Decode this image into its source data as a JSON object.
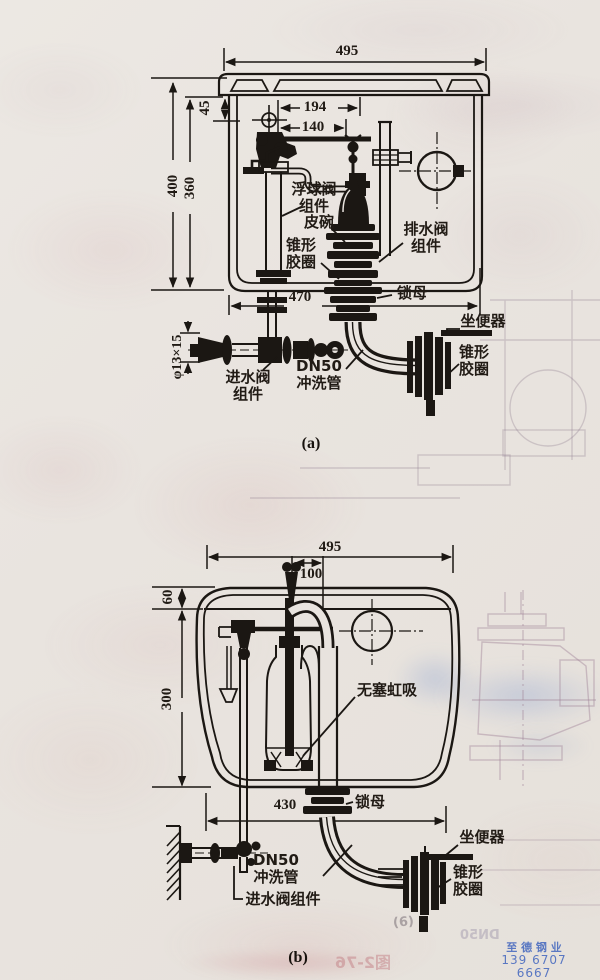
{
  "diagram_a": {
    "caption": "(a)",
    "dims": {
      "width_top": "495",
      "lid_height": "45",
      "height_total": "400",
      "height_inner": "360",
      "arm_span": "194",
      "arm_span_inner": "140",
      "width_bottom": "470",
      "inlet_pipe": "φ13×15"
    },
    "labels": {
      "float_valve": "浮球阀\n组件",
      "rubber_cup": "皮碗",
      "cone_ring_left": "锥形\n胶圈",
      "drain_valve": "排水阀\n组件",
      "lock_nut": "锁母",
      "toilet": "坐便器",
      "cone_ring_right": "锥形\n胶圈",
      "inlet_valve": "进水阀\n组件",
      "flush_pipe": "DN50\n冲洗管"
    }
  },
  "diagram_b": {
    "caption": "(b)",
    "dims": {
      "width_top": "495",
      "inlet_offset": "100",
      "top_gap": "60",
      "body_height": "300",
      "width_bottom": "430"
    },
    "labels": {
      "siphon": "无塞虹吸",
      "lock_nut": "锁母",
      "toilet": "坐便器",
      "cone_ring": "锥形\n胶圈",
      "flush_pipe": "DN50\n冲洗管",
      "inlet_valve": "进水阀组件"
    }
  },
  "watermark": {
    "company": "至 德 钢 业",
    "phone": "139 6707 6667",
    "color": "#4a6cc0"
  },
  "ghosts": {
    "sub_caption": "(6)",
    "figure_ref": "图2-76",
    "pipe_ref": "DN50"
  }
}
